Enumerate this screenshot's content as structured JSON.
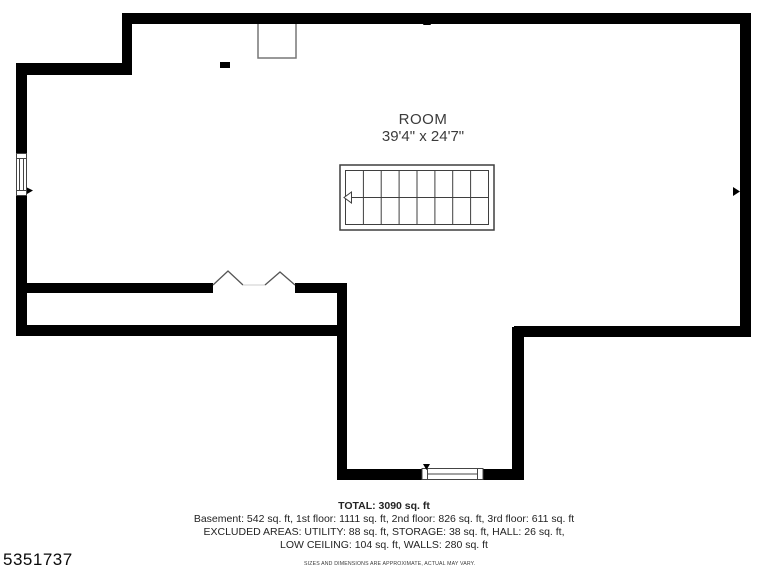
{
  "plan": {
    "room": {
      "name": "ROOM",
      "dimensions": "39'4\" x 24'7\""
    },
    "summary": {
      "total": "TOTAL: 3090 sq. ft",
      "line1": "Basement: 542 sq. ft, 1st floor: 1111 sq. ft, 2nd floor: 826 sq. ft, 3rd floor: 611 sq. ft",
      "line2": "EXCLUDED AREAS: UTILITY: 88 sq. ft, STORAGE: 38 sq. ft, HALL: 26 sq. ft,",
      "line3": "LOW CEILING: 104 sq. ft, WALLS: 280 sq. ft"
    },
    "listing_id": "5351737",
    "disclaimer": "SIZES AND DIMENSIONS ARE APPROXIMATE, ACTUAL MAY VARY.",
    "stairs": {
      "steps": 8,
      "direction": "up-left"
    },
    "colors": {
      "wall": "#000000",
      "thin_line": "#3f3f3f",
      "fixture_border": "#777777",
      "door_line": "#555555",
      "text": "#232323",
      "background": "#ffffff"
    }
  }
}
